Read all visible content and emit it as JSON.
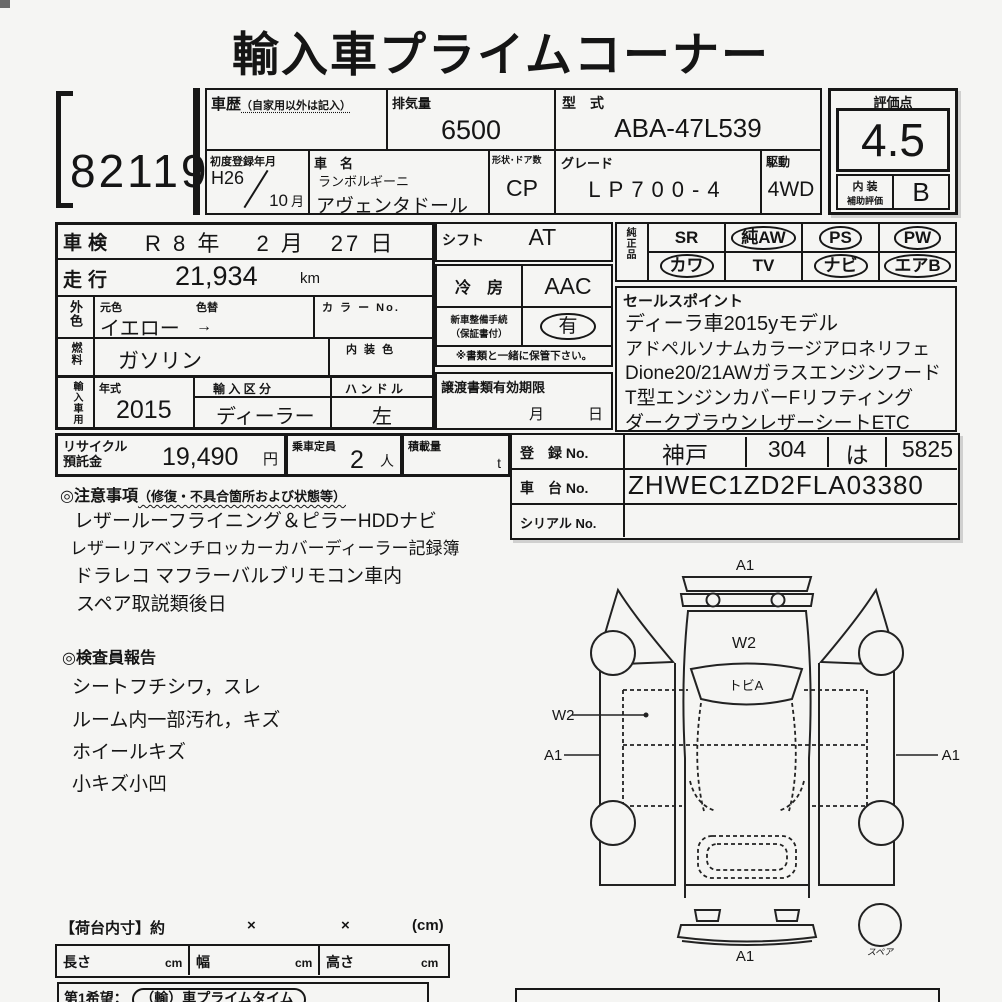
{
  "title": "輸入車プライムコーナー",
  "lot_number": "82119",
  "header": {
    "history_label": "車歴",
    "history_note": "（自家用以外は記入）",
    "displacement_label": "排気量",
    "displacement_value": "6500",
    "model_code_label": "型　式",
    "model_code_value": "ABA-47L539",
    "first_reg_label": "初度登録年月",
    "first_reg_year": "H26",
    "first_reg_month": "10",
    "first_reg_month_suffix": "月",
    "car_name_label": "車　名",
    "maker": "ランボルギーニ",
    "car_name": "アヴェンタドール",
    "body_label": "形状･ドア数",
    "body_value": "CP",
    "grade_label": "グレード",
    "grade_value": "LP700-4",
    "drive_label": "駆動",
    "drive_value": "4WD"
  },
  "rating": {
    "label": "評価点",
    "score": "4.5",
    "interior_label_top": "内 装",
    "interior_label_bottom": "補助評価",
    "interior_grade": "B"
  },
  "left_table": {
    "shaken_label": "車検",
    "shaken_value": "R 8 年　 2 月　27 日",
    "mileage_label": "走行",
    "mileage_value": "21,934",
    "mileage_unit": "km",
    "ext_color_label": "外色",
    "orig_color_label": "元色",
    "color_change_label": "色替",
    "color_value": "イエロー",
    "color_arrow": "→",
    "color_no_label": "カ ラ ー No.",
    "fuel_label": "燃料",
    "fuel_value": "ガソリン",
    "interior_color_label": "内 装 色",
    "import_label": "輸入車用",
    "year_label": "年式",
    "year_value": "2015",
    "import_type_label": "輸 入 区 分",
    "import_type_value": "ディーラー",
    "handle_label": "ハ ン ド ル",
    "handle_value": "左"
  },
  "mid_table": {
    "shift_label": "シフト",
    "shift_value": "AT",
    "ac_label": "冷　房",
    "ac_value": "AAC",
    "newcar_label_1": "新車整備手続",
    "newcar_label_2": "（保証書付）",
    "newcar_value": "有",
    "note": "※書類と一緒に保管下さい。",
    "transfer_label": "譲渡書類有効期限",
    "transfer_month": "月",
    "transfer_day": "日"
  },
  "equipment": {
    "label": "純正品",
    "items": [
      {
        "label": "SR",
        "circled": false
      },
      {
        "label": "純AW",
        "circled": true
      },
      {
        "label": "PS",
        "circled": true
      },
      {
        "label": "PW",
        "circled": true
      },
      {
        "label": "カワ",
        "circled": true
      },
      {
        "label": "TV",
        "circled": false
      },
      {
        "label": "ナビ",
        "circled": true
      },
      {
        "label": "エアB",
        "circled": true
      }
    ]
  },
  "sales_points": {
    "label": "セールスポイント",
    "lines": [
      "ディーラ車2015yモデル",
      "アドペルソナムカラージアロネリフェ",
      "Dione20/21AWガラスエンジンフード",
      "T型エンジンカバーFリフティング",
      "ダークブラウンレザーシートETC"
    ]
  },
  "recycle": {
    "label_1": "リサイクル",
    "label_2": "預託金",
    "value": "19,490",
    "unit": "円",
    "capacity_label": "乗車定員",
    "capacity_value": "2",
    "capacity_unit": "人",
    "load_label": "積載量",
    "load_unit": "t"
  },
  "registration": {
    "reg_label": "登　録 No.",
    "reg_area": "神戸",
    "reg_class": "304",
    "reg_kana": "は",
    "reg_number": "5825",
    "chassis_label": "車　台 No.",
    "chassis_value": "ZHWEC1ZD2FLA03380",
    "serial_label": "シリアル No.",
    "serial_value": ""
  },
  "notes": {
    "title_main": "◎注意事項",
    "title_sub": "（修復・不具合箇所および状態等）",
    "lines": [
      "レザールーフライニング＆ピラーHDDナビ",
      "レザーリアベンチロッカーカバーディーラー記録簿",
      "ドラレコ マフラーバルブリモコン車内",
      "スペア取説類後日"
    ]
  },
  "inspector": {
    "title": "◎検査員報告",
    "lines": [
      "シートフチシワ，スレ",
      "ルーム内一部汚れ，キズ",
      "ホイールキズ",
      "小キズ小凹"
    ]
  },
  "diagram": {
    "label_front": "A1",
    "label_hood": "W2",
    "label_windshield": "トビA",
    "label_left_door": "W2",
    "label_left_side": "A1",
    "label_right_side": "A1",
    "label_rear": "A1",
    "label_spare": "スペア"
  },
  "cargo": {
    "title": "【荷台内寸】約",
    "x1": "×",
    "x2": "×",
    "unit": "(cm)",
    "length_label": "長さ",
    "width_label": "幅",
    "height_label": "高さ",
    "cm": "cm"
  },
  "footer": {
    "wish_prefix": "第1希望：",
    "wish_value": "（輸）車プライムタイム"
  }
}
